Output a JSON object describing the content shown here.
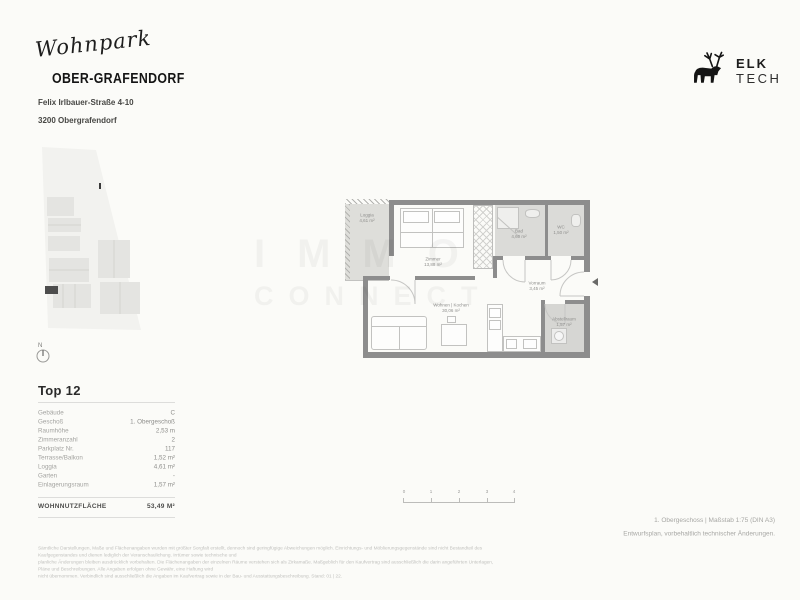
{
  "header": {
    "project_script": "Wohnpark",
    "project_name": "OBER-GRAFENDORF",
    "address_line1": "Felix Irlbauer-Straße 4-10",
    "address_line2": "3200 Obergrafendorf"
  },
  "logo": {
    "line1": "ELK",
    "line2": "TECH",
    "icon": "elk-silhouette"
  },
  "watermark": {
    "line1": "IMMO",
    "line2": "CONNECT"
  },
  "site_plan": {
    "north_label": "N",
    "highlight_color": "#4d4d4d",
    "building_color": "#e4e4e1",
    "parcel_color": "#f2f2ef"
  },
  "floor_plan": {
    "wall_color": "#8d8d8d",
    "rooms": [
      {
        "name": "Loggia",
        "area": "4,61 m²"
      },
      {
        "name": "Zimmer",
        "area": "13,88 m²"
      },
      {
        "name": "Bad",
        "area": "4,60 m²"
      },
      {
        "name": "WC",
        "area": "1,50 m²"
      },
      {
        "name": "Vorraum",
        "area": "3,45 m²"
      },
      {
        "name": "Wohnen | Kochen",
        "area": "30,06 m²"
      },
      {
        "name": "Abstellraum",
        "area": "1,57 m²"
      }
    ]
  },
  "scale_bar": {
    "labels": [
      "0",
      "1",
      "2",
      "3",
      "4"
    ]
  },
  "unit_table": {
    "title": "Top 12",
    "rows": [
      {
        "label": "Gebäude",
        "value": "C"
      },
      {
        "label": "Geschoß",
        "value": "1. Obergeschoß"
      },
      {
        "label": "Raumhöhe",
        "value": "2,53 m"
      },
      {
        "label": "Zimmeranzahl",
        "value": "2"
      },
      {
        "label": "Parkplatz Nr.",
        "value": "117"
      },
      {
        "label": "Terrasse/Balkon",
        "value": "1,52 m²"
      },
      {
        "label": "Loggia",
        "value": "4,61 m²"
      },
      {
        "label": "Garten",
        "value": "-"
      },
      {
        "label": "Einlagerungsraum",
        "value": "1,57 m²"
      }
    ],
    "total_label": "WOHNNUTZFLÄCHE",
    "total_value": "53,49 M²"
  },
  "notes": {
    "line1": "1. Obergeschoss | Maßstab 1:75 (DIN A3)",
    "line2": "Entwurfsplan, vorbehaltlich technischer Änderungen."
  },
  "disclaimer": {
    "line1": "Sämtliche Darstellungen, Maße und Flächenangaben wurden mit größter Sorgfalt erstellt, dennoch sind geringfügige Abweichungen möglich. Einrichtungs- und Möblierungsgegenstände sind nicht Bestandteil des Kaufgegenstandes und dienen lediglich der Veranschaulichung. Irrtümer sowie technische und",
    "line2": "planliche Änderungen bleiben ausdrücklich vorbehalten. Die Flächenangaben der einzelnen Räume verstehen sich als Zirkamaße. Maßgeblich für den Kaufvertrag sind ausschließlich die darin angeführten Unterlagen, Pläne und Beschreibungen. Alle Angaben erfolgen ohne Gewähr, eine Haftung wird",
    "line3": "nicht übernommen. Verbindlich sind ausschließlich die Angaben im Kaufvertrag sowie in der Bau- und Ausstattungsbeschreibung. Stand: 01 | 22."
  }
}
